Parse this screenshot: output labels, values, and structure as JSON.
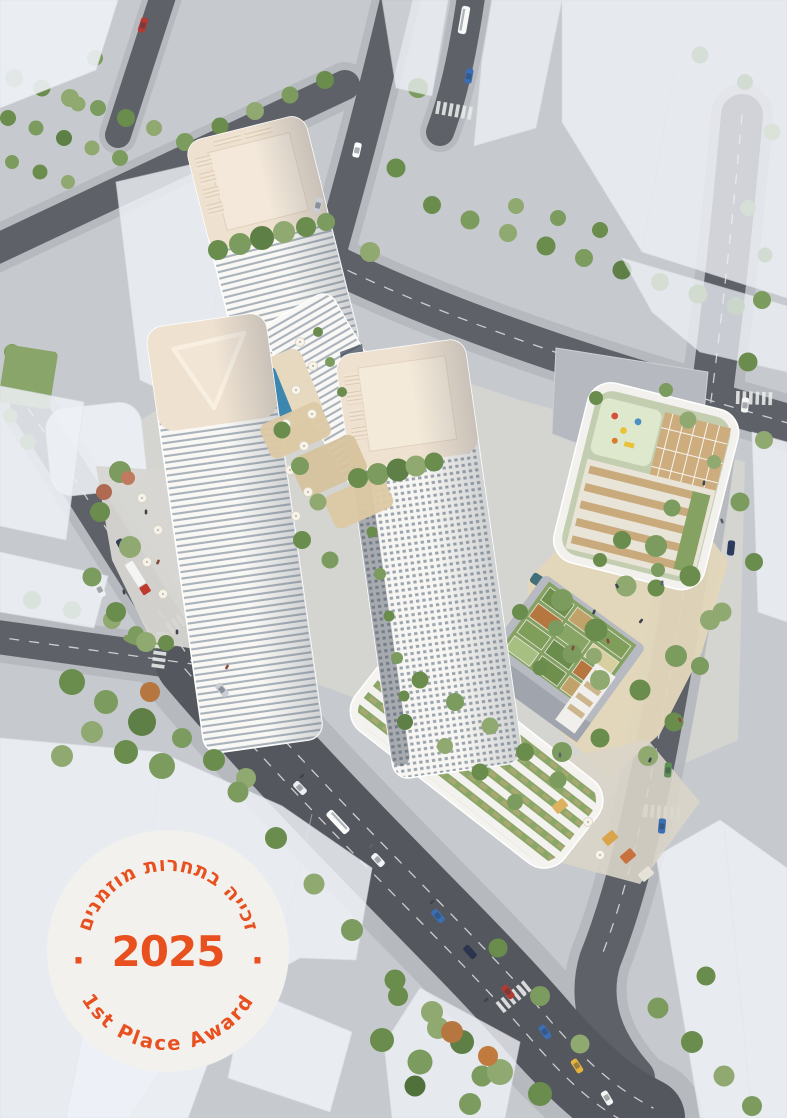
{
  "badge": {
    "shape": "circle",
    "top_text": "זכייה בתחרות מוזמנים",
    "year": "2025",
    "bottom_text": "1st Place Award",
    "separator_left": "·",
    "separator_right": "·",
    "accent_color": "#e8501f",
    "background_color": "#f2f1ee"
  },
  "scene": {
    "type": "aerial architectural rendering",
    "description": "Bird's-eye view of a mixed-use development: three cream high-rise towers with banded balconies, landscaped podium roofs with gardens, playground, rooftop pool, a sandy central plaza, tree-lined streets with traffic, surrounded by translucent white massing of context buildings",
    "towers_count": 3
  },
  "palette": {
    "tower_roof": "#eee1d0",
    "tower_facade": "#f9f8f5",
    "facade_glass": "#a9b2ba",
    "asphalt": "#585c62",
    "sidewalk": "#b5b9be",
    "ghost_building": "#eef1f6",
    "tree_green": "#7b9c5e",
    "green_roof": "#86a262",
    "plaza_sand": "#e2d6ba",
    "pool_blue": "#3c86af",
    "wood_deck": "#cdad7e",
    "water_feature": "#41707a"
  }
}
